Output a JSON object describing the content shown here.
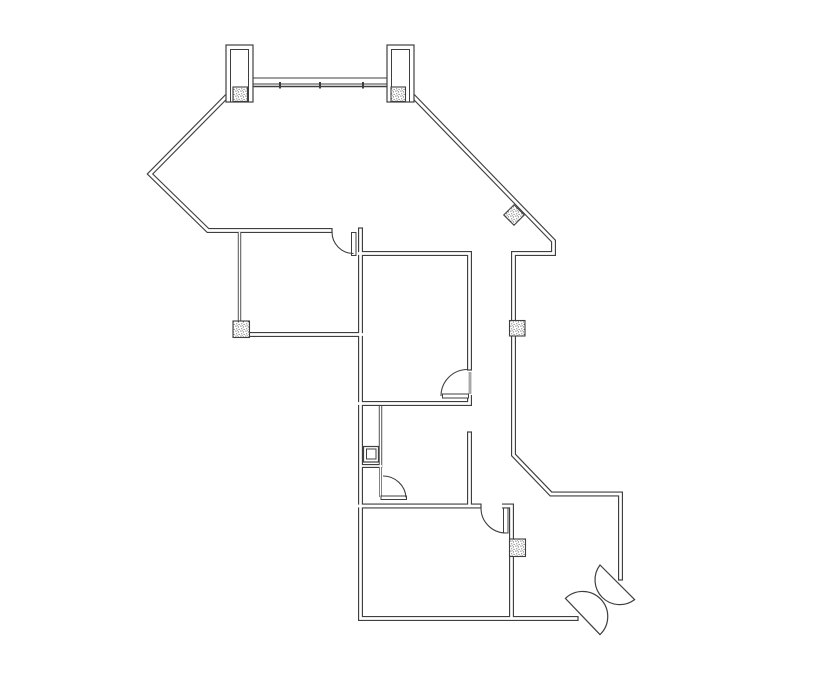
{
  "document": {
    "type": "architectural-floor-plan",
    "canvas": {
      "width": 835,
      "height": 678
    },
    "colors": {
      "ink": "#3f3f3f",
      "background": "#ffffff"
    }
  },
  "floorplan": {
    "wall_groups": [
      {
        "name": "exterior-wall",
        "outer": 5,
        "core": 2.7,
        "runs": [
          [
            [
              227,
              96
            ],
            [
              150,
              174
            ],
            [
              208,
              230.5
            ],
            [
              332,
              230.5
            ]
          ],
          [
            [
              360.5,
              228
            ],
            [
              360.5,
              618.5
            ],
            [
              578,
              618.5
            ]
          ],
          [
            [
              413,
              96
            ],
            [
              553.5,
              241
            ],
            [
              553.5,
              253.5
            ],
            [
              513.5,
              253.5
            ],
            [
              513.5,
              455
            ],
            [
              551,
              494
            ],
            [
              620.5,
              494
            ],
            [
              620.5,
              580
            ]
          ]
        ]
      },
      {
        "name": "interior-wall",
        "outer": 5,
        "core": 2.7,
        "runs": [
          [
            [
              249,
              334.5
            ],
            [
              363,
              334.5
            ]
          ],
          [
            [
              358,
              253.5
            ],
            [
              469.5,
              253.5
            ],
            [
              469.5,
              370
            ]
          ],
          [
            [
              469.5,
              395
            ],
            [
              469.5,
              403.5
            ],
            [
              358,
              403.5
            ]
          ],
          [
            [
              469.5,
              432
            ],
            [
              469.5,
              506
            ]
          ],
          [
            [
              358,
              506
            ],
            [
              481,
              506
            ]
          ],
          [
            [
              502,
              506
            ],
            [
              511.5,
              506
            ],
            [
              511.5,
              618
            ]
          ]
        ]
      },
      {
        "name": "partition-wall",
        "outer": 3.4,
        "core": 1.6,
        "runs": [
          [
            [
              239.5,
              232
            ],
            [
              239.5,
              322
            ]
          ],
          [
            [
              380.5,
              406
            ],
            [
              380.5,
              468
            ]
          ]
        ]
      },
      {
        "name": "shelf-wall",
        "outer": 4,
        "core": 1.8,
        "runs": [
          [
            [
              361,
              466
            ],
            [
              382,
              466
            ]
          ]
        ]
      },
      {
        "name": "door-jamb-line",
        "outer": 2.4,
        "core": 1.1,
        "runs": [
          [
            [
              380.5,
              468
            ],
            [
              380.5,
              497
            ]
          ],
          [
            [
              470,
              372
            ],
            [
              470,
              394
            ]
          ]
        ]
      }
    ],
    "end_caps": [
      [
        [
          332,
          228
        ],
        [
          332,
          233
        ]
      ],
      [
        [
          358,
          228
        ],
        [
          363,
          228
        ]
      ],
      [
        [
          467,
          370
        ],
        [
          472,
          370
        ]
      ],
      [
        [
          467,
          432
        ],
        [
          472,
          432
        ]
      ],
      [
        [
          481,
          503.5
        ],
        [
          481,
          508.5
        ]
      ],
      [
        [
          578,
          616
        ],
        [
          578,
          621
        ]
      ],
      [
        [
          618,
          580
        ],
        [
          623,
          580
        ]
      ]
    ],
    "doors": [
      {
        "name": "door-top-left-room",
        "arc": "M332,232 A21.5,21.5 0 0 0 353.5,253.5",
        "leaf": [
          351.5,
          232.5,
          4.5,
          23
        ]
      },
      {
        "name": "door-middle-room",
        "arc": "M441,396 A26.5,26.5 0 0 1 467.5,369.5",
        "leaf": [
          442.5,
          394,
          26,
          4
        ]
      },
      {
        "name": "door-bathroom",
        "arc": "M383,476 A23,23 0 0 1 406,497.5",
        "leaf": [
          381,
          496,
          25.5,
          3.5
        ]
      },
      {
        "name": "door-bottom-room",
        "arc": "M481,508 A25,25 0 0 0 506,533",
        "leaf": [
          503.5,
          508,
          4.5,
          25
        ]
      }
    ],
    "double_door": {
      "name": "double-entry-door",
      "leaf_paths": [
        "M600,565 A24.7,24.7 0 0 0 634.6,599.6 Z",
        "M565.4,598.4 A24.7,24.7 0 0 1 600,634.6 Z"
      ]
    },
    "columns": {
      "squares": [
        [
          233,
          87,
          14.5,
          14.5
        ],
        [
          391,
          87,
          14.5,
          14.5
        ],
        [
          233,
          321,
          16.5,
          16.5
        ],
        [
          509.5,
          320.5,
          15.5,
          15.5
        ],
        [
          509.5,
          539,
          16,
          17.5
        ]
      ],
      "diamond_path": "M514,204.75 L524.25,215 L514,225.25 L503.75,215 Z"
    },
    "pilasters": [
      {
        "outer": [
          226,
          45,
          27,
          57
        ],
        "inner": [
          230.5,
          49.5,
          18,
          52.5
        ]
      },
      {
        "outer": [
          387,
          45,
          27,
          57
        ],
        "inner": [
          391.5,
          49.5,
          18,
          52.5
        ]
      }
    ],
    "window": {
      "x1": 253,
      "x2": 387,
      "lines": [
        {
          "y": 78,
          "w": 1
        },
        {
          "y": 84,
          "w": 1
        },
        {
          "y": 86.5,
          "w": 1.5
        }
      ],
      "mullions": {
        "xs": [
          280,
          320,
          363
        ],
        "y1": 82,
        "y2": 88.5,
        "w": 2
      }
    },
    "fixture": {
      "name": "plumbing-fixture",
      "outer": [
        363.5,
        446.5,
        15,
        15.5
      ],
      "inner": [
        366.5,
        449,
        9.5,
        10
      ]
    }
  }
}
